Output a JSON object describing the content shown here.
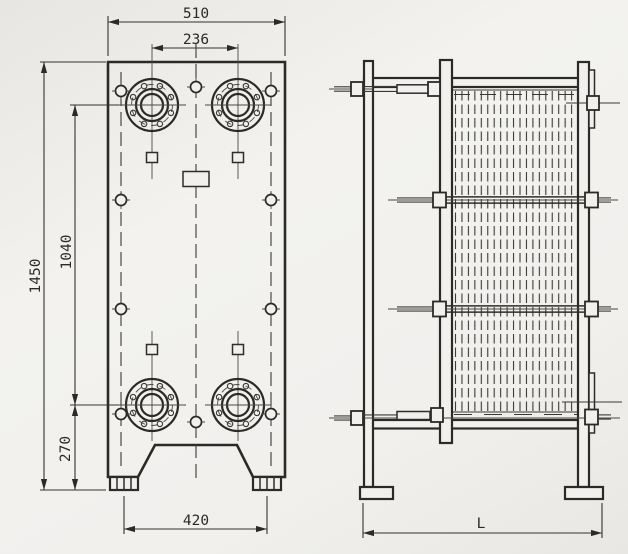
{
  "drawing": {
    "subject": "plate-heat-exchanger-technical-drawing",
    "views": {
      "front": "front elevation",
      "side": "side elevation"
    },
    "dimensions": {
      "overall_width_mm": "510",
      "port_spacing_horizontal_mm": "236",
      "overall_height_mm": "1450",
      "port_spacing_vertical_mm": "1040",
      "port_to_base_mm": "270",
      "foot_spacing_mm": "420",
      "frame_length": "L"
    },
    "colors": {
      "line": "#2b2a27",
      "thin_line": "#4a4944",
      "background": "#f1f0ed"
    }
  }
}
